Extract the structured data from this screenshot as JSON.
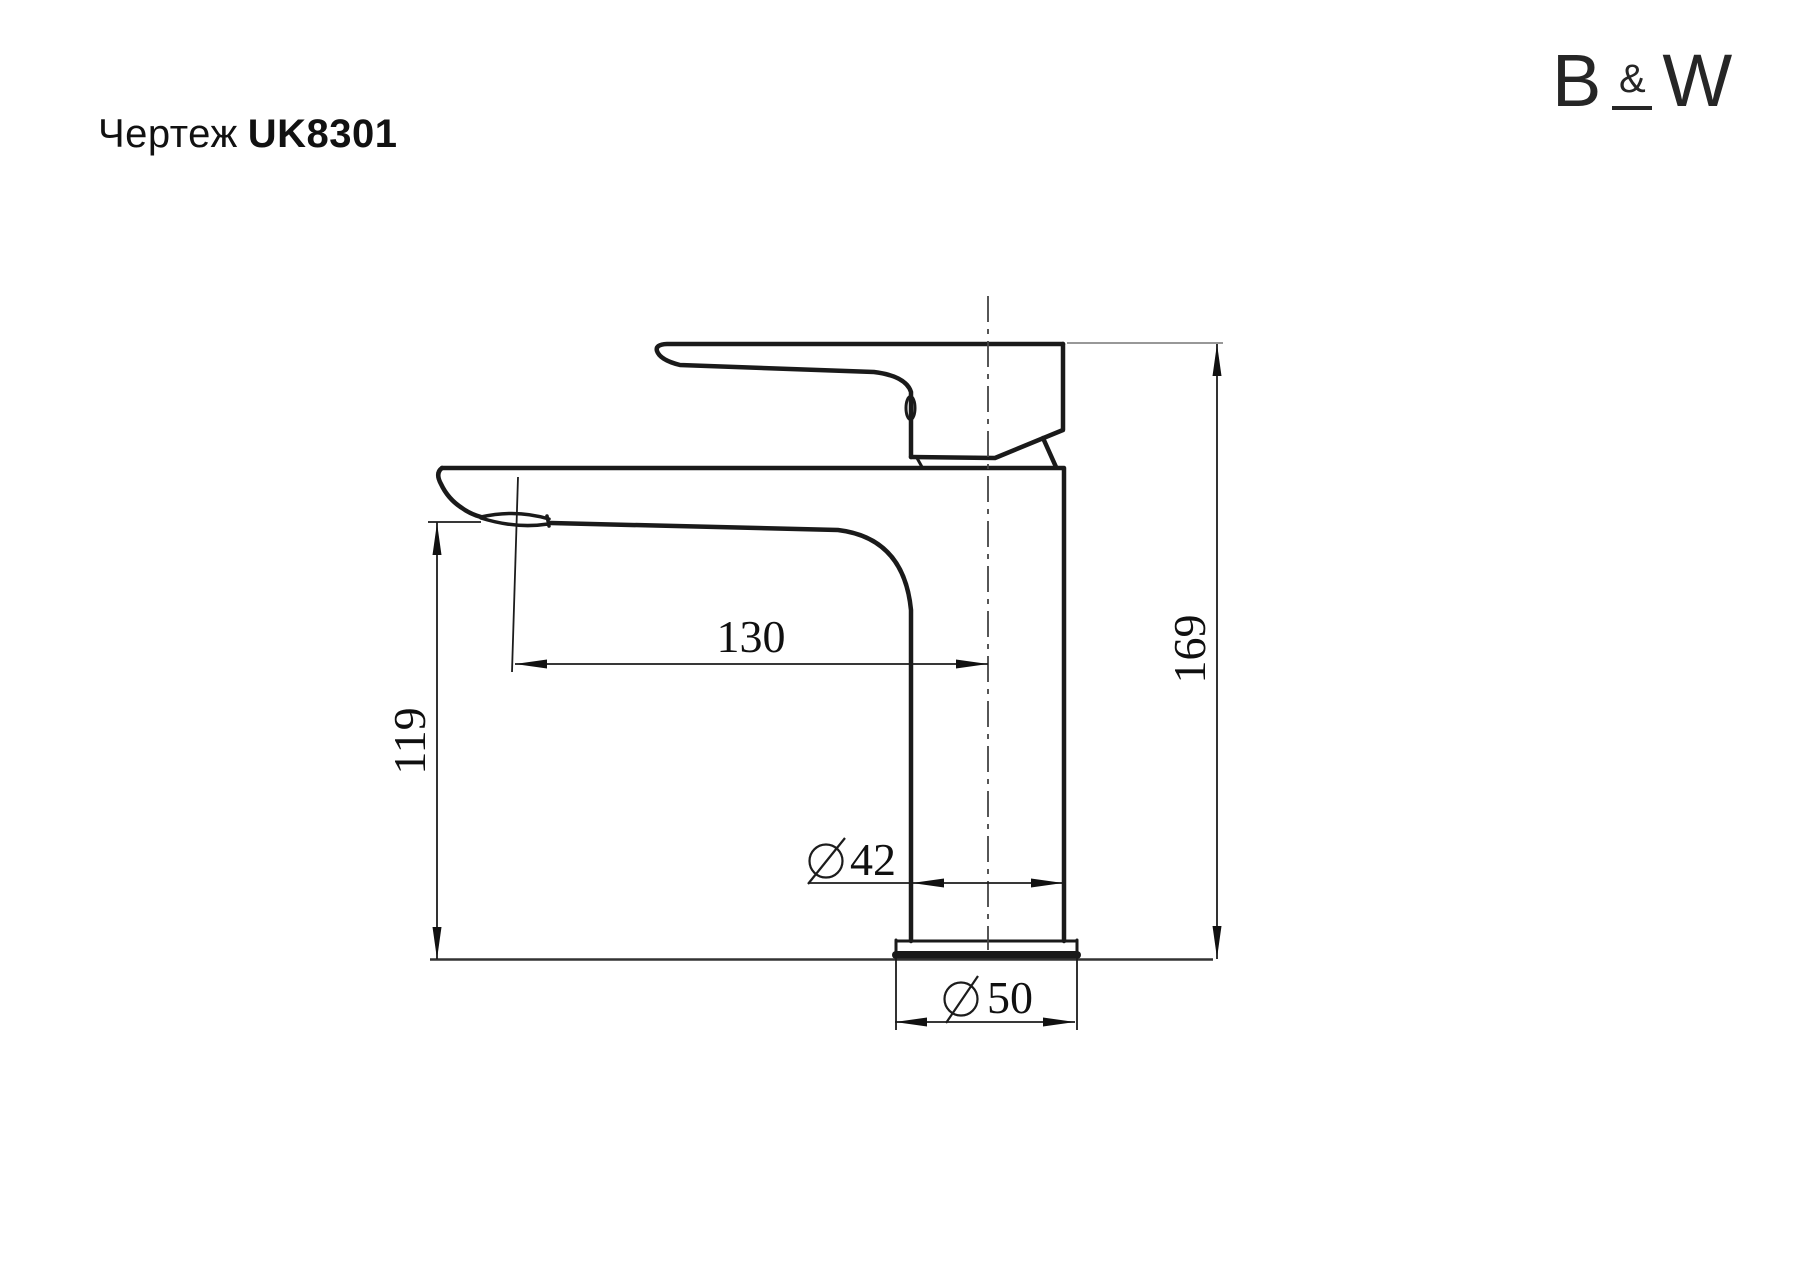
{
  "title": {
    "prefix": "Чертеж",
    "code": "UK8301"
  },
  "logo": {
    "b": "B",
    "amp": "&",
    "w": "W"
  },
  "drawing": {
    "type": "technical-dimension-drawing",
    "subject": "single-lever basin faucet, side view",
    "line_color": "#1a1a1a",
    "dimensions": {
      "spout_reach": {
        "value": "130",
        "unit": "mm",
        "orientation": "horizontal"
      },
      "spout_height": {
        "value": "119",
        "unit": "mm",
        "orientation": "vertical"
      },
      "total_height": {
        "value": "169",
        "unit": "mm",
        "orientation": "vertical"
      },
      "body_diameter": {
        "value": "42",
        "unit": "mm",
        "symbol": "⌀"
      },
      "base_diameter": {
        "value": "50",
        "unit": "mm",
        "symbol": "⌀"
      }
    }
  }
}
